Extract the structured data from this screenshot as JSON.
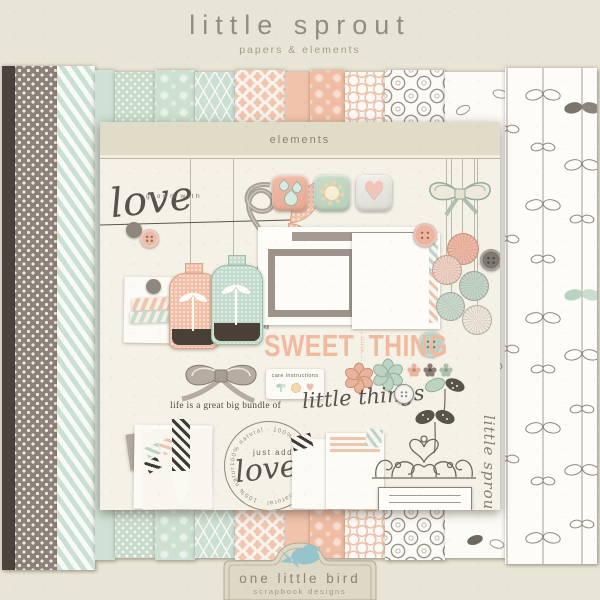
{
  "header": {
    "title": "little sprout",
    "subtitle": "papers & elements"
  },
  "panel": {
    "header_label": "elements"
  },
  "el": {
    "grown_with": "grown with",
    "love": "love",
    "sweet": "SWEET",
    "little_mid": "little",
    "thing": "THING",
    "care_label": "care instructions",
    "bundle": "life is a great big bundle of",
    "little_things": "little things",
    "just_add": "just add",
    "love2": "love",
    "ring_text": "100% natural · 100% natural · 100% natural · 100% natural",
    "little_sprout_vertical": "little sprout"
  },
  "footer": {
    "brand": "one little bird",
    "sub": "scrapbook designs"
  },
  "palette": {
    "background": "#e9e5d6",
    "panel": "#f4f1e6",
    "charcoal": "#4a433e",
    "taupe": "#8d8279",
    "mint": "#cfe2d6",
    "peach": "#f2c6ae",
    "peach_text": "#f2b99e",
    "bird_blue": "#95c4cb",
    "title_gray": "#8f8e81"
  },
  "papers": [
    {
      "name": "solid charcoal",
      "color": "#4a433e"
    },
    {
      "name": "taupe cross",
      "color": "#8d8279"
    },
    {
      "name": "mint diagonal stripe",
      "color": "#cfe2d6"
    },
    {
      "name": "solid mint",
      "color": "#cfe0d5"
    },
    {
      "name": "mint cross",
      "color": "#c8dccd"
    },
    {
      "name": "mint damask",
      "color": "#cde0d2"
    },
    {
      "name": "mint honeycomb",
      "color": "#cbdfd3"
    },
    {
      "name": "peach lattice",
      "color": "#f2c6ae"
    },
    {
      "name": "solid peach",
      "color": "#f1c3ab"
    },
    {
      "name": "peach damask",
      "color": "#efbda3"
    },
    {
      "name": "white peach rings",
      "color": "#fbfaf6"
    },
    {
      "name": "white buttons",
      "color": "#fcfbf8"
    },
    {
      "name": "white leaves",
      "color": "#fcfbf7"
    },
    {
      "name": "white leaf vine",
      "color": "#fdfcf9"
    }
  ]
}
